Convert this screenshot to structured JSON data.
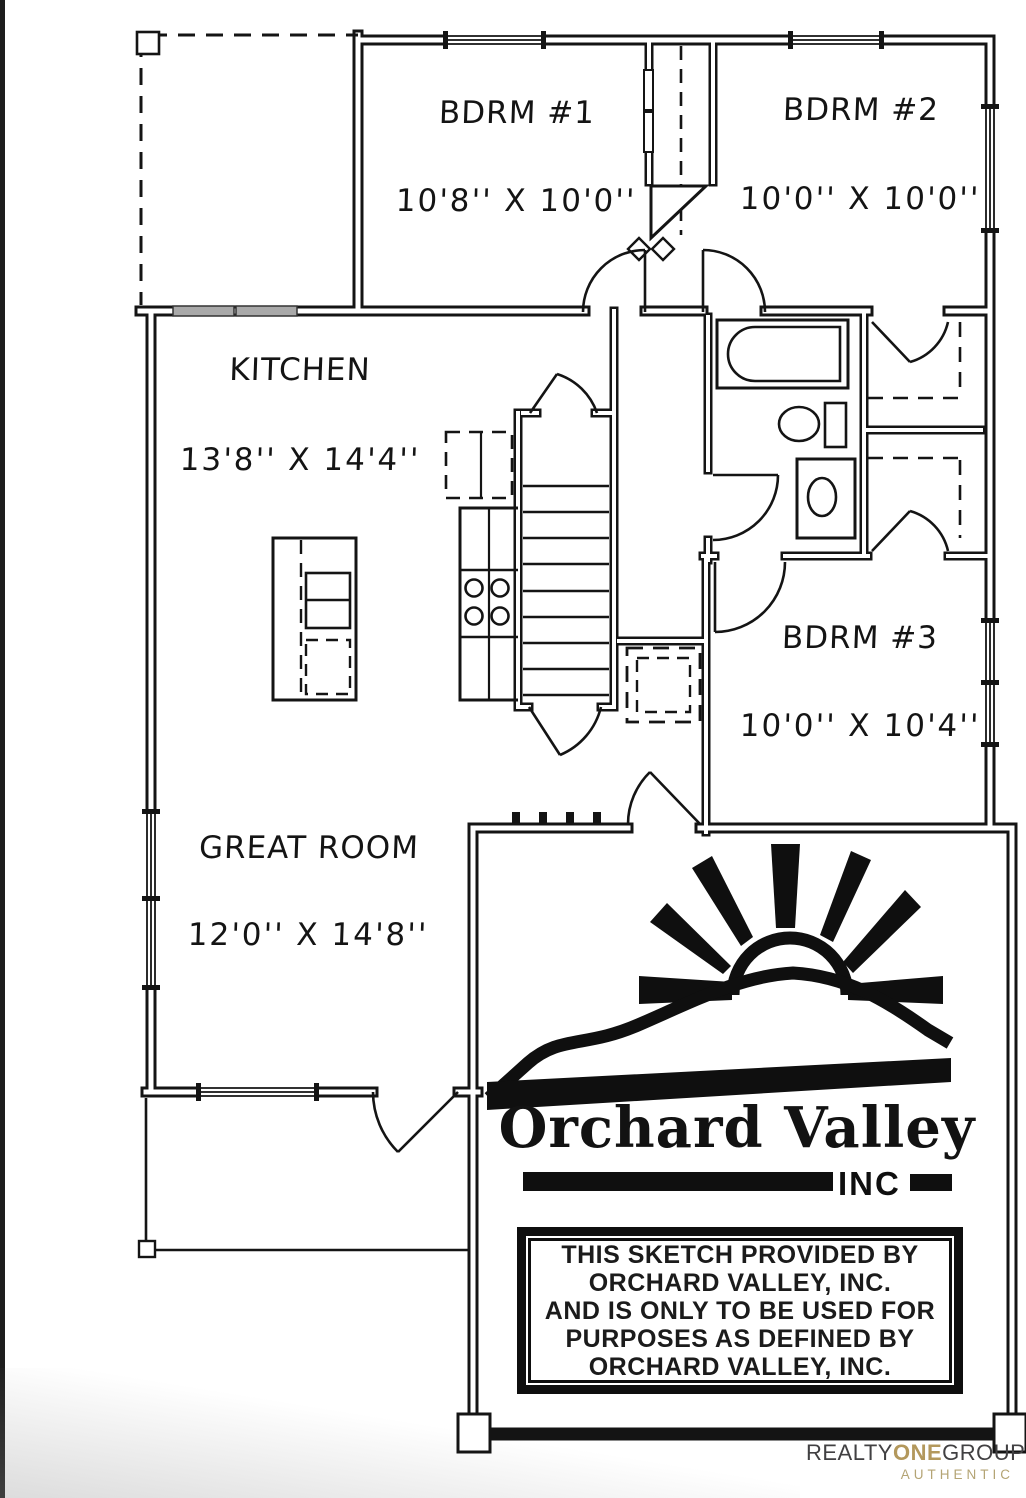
{
  "floorplan": {
    "line_color": "#141414",
    "rooms": [
      {
        "id": "bdrm1",
        "label": "BDRM #1",
        "dims": "10'8'' X 10'0''"
      },
      {
        "id": "bdrm2",
        "label": "BDRM #2",
        "dims": "10'0'' X 10'0''"
      },
      {
        "id": "kitchen",
        "label": "KITCHEN",
        "dims": "13'8'' X 14'4''"
      },
      {
        "id": "bdrm3",
        "label": "BDRM #3",
        "dims": "10'0'' X 10'4''"
      },
      {
        "id": "greatroom",
        "label": "GREAT ROOM",
        "dims": "12'0'' X 14'8''"
      }
    ]
  },
  "branding": {
    "company": "Orchard Valley",
    "suffix": "INC",
    "disclaimer_lines": [
      "THIS SKETCH PROVIDED BY",
      "ORCHARD VALLEY, INC.",
      "AND IS ONLY TO BE USED FOR",
      "PURPOSES AS DEFINED BY",
      "ORCHARD VALLEY, INC."
    ]
  },
  "footer_logo": {
    "realty": "REALTY",
    "one": "ONE",
    "group": "GROUP",
    "authentic": "AUTHENTIC",
    "text_color": "#414042",
    "one_color": "#b3985c",
    "authentic_color": "#b4a474"
  }
}
